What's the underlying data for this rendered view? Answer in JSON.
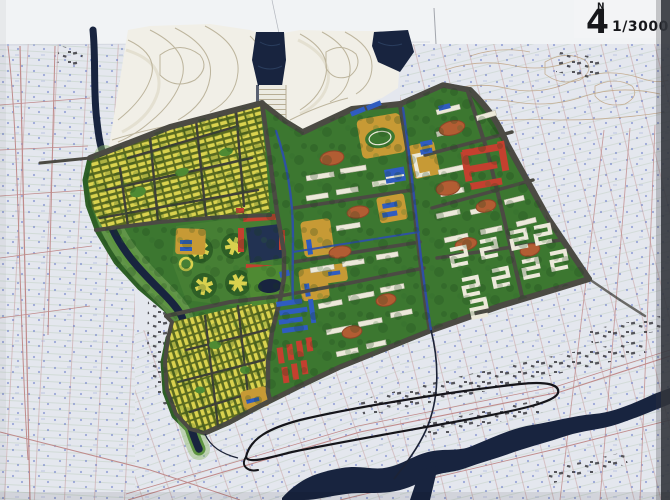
{
  "titleblock": {
    "north_label": "N",
    "north_glyph": "4",
    "scale": "1/3000"
  },
  "palette": {
    "paper": "#e4e7ee",
    "band": "#f3f4f6",
    "ink": "#17181c",
    "pink": "#c08b8b",
    "mapgreen": "#9cb795",
    "mapblue": "#5e72c4",
    "tan": "#bfa483",
    "terrain": "#f1efe7",
    "tline": "#b7ae95",
    "tshadow": "#d9d3c0",
    "navy": "#18243f",
    "navy2": "#223252",
    "navytex": "#32486b",
    "green": "#3c7730",
    "green2": "#467f34",
    "green3": "#2e5f26",
    "bank": "#5d9440",
    "bankpale": "#8fb968",
    "park": "#4f8a33",
    "road": "#4b4a43",
    "lane": "#3f4038",
    "ybar": "#d9d24e",
    "ybg": "#5a6a20",
    "ochre": "#c79a35",
    "red": "#c4402f",
    "blue": "#2f5cc0",
    "canal": "#2d4fae",
    "bldg": "#ece9da",
    "oval": "#b25d33",
    "treed": "#173f17",
    "specks": "#3a3a40",
    "black": "#15151a",
    "crack": "#8a8f9a",
    "edge": "#32353c"
  }
}
